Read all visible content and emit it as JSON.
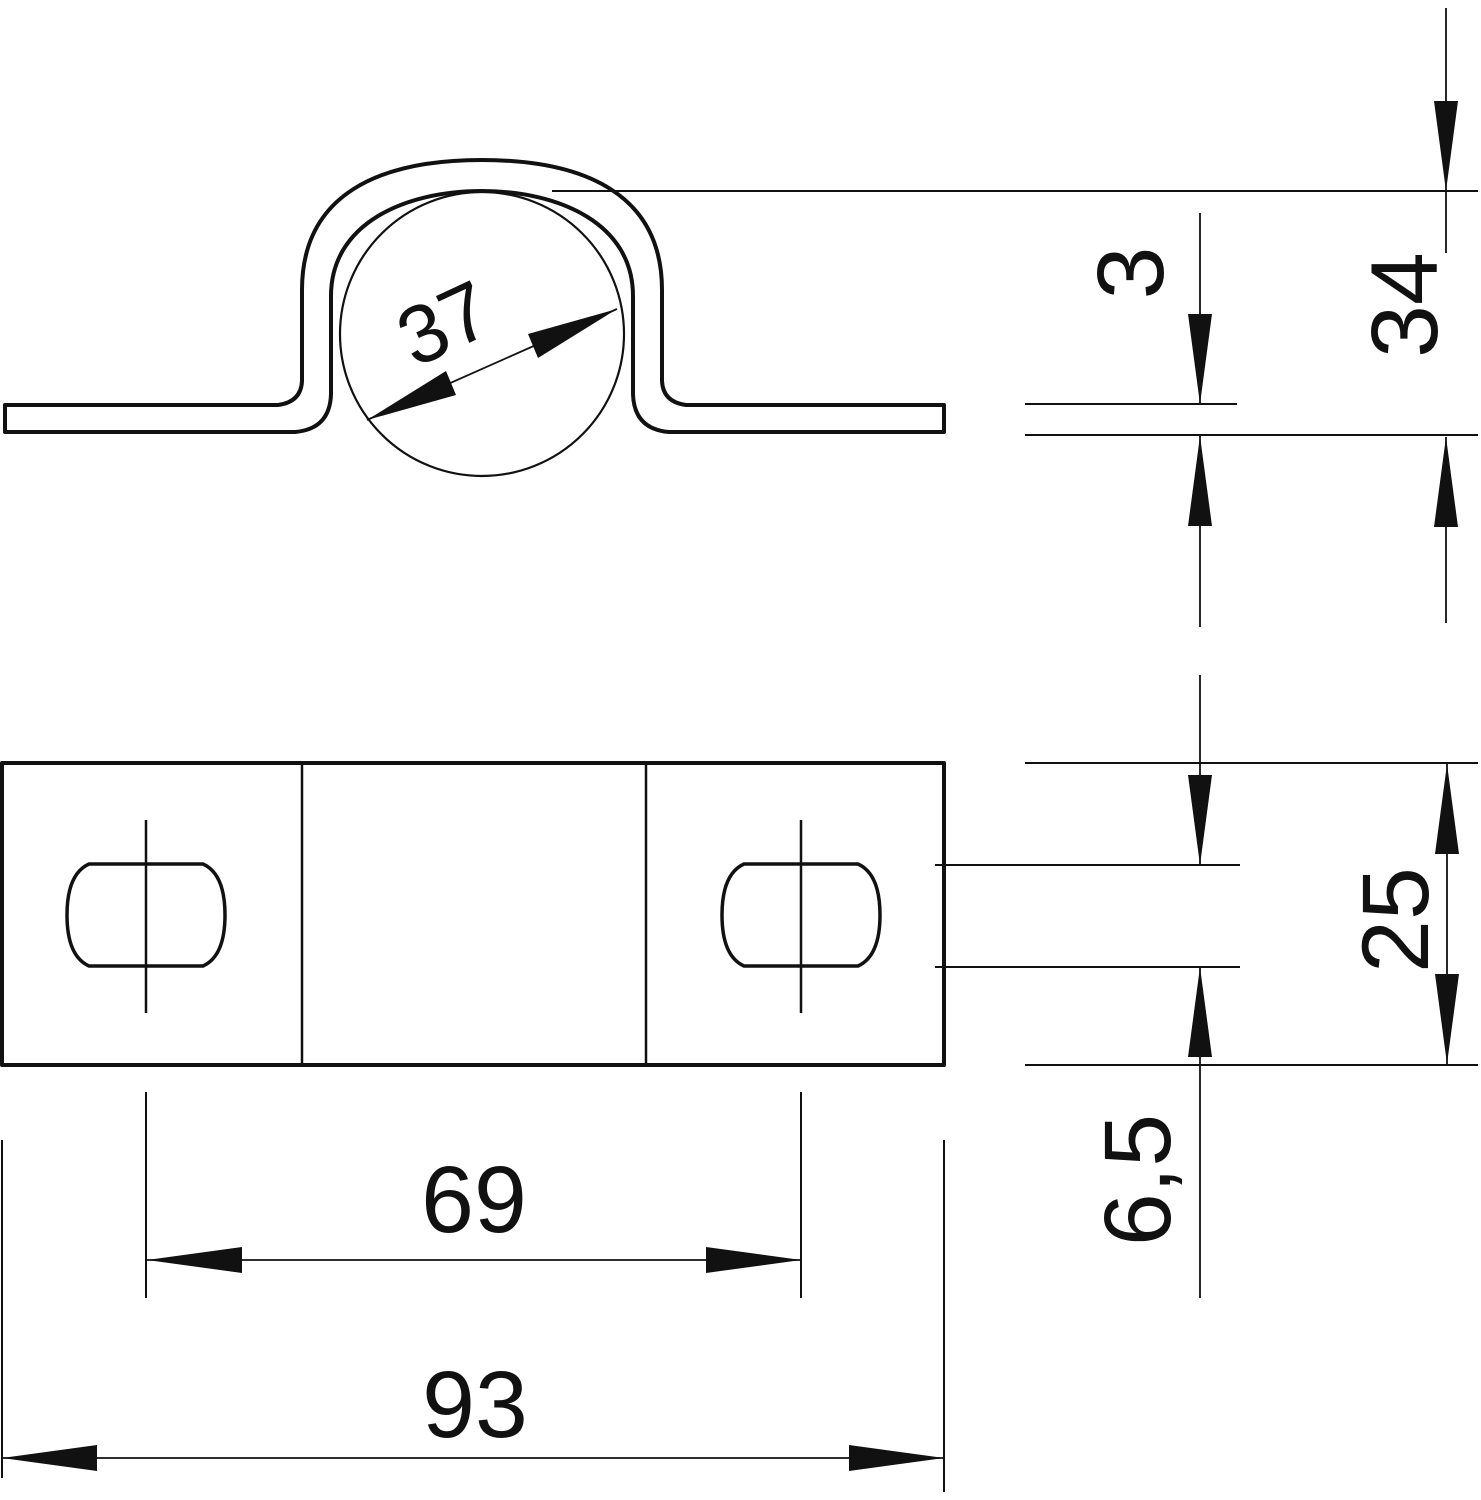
{
  "drawing": {
    "type": "technical dimension drawing",
    "subject": "saddle pipe clamp, side profile view and plan view with slotted fixing holes",
    "colors": {
      "line": "#111111",
      "background": "#ffffff"
    },
    "dimensions": {
      "pipe_diameter": {
        "label": "37"
      },
      "material_thickness": {
        "label": "3"
      },
      "overall_height": {
        "label": "34"
      },
      "strap_width": {
        "label": "25"
      },
      "slot_width": {
        "label": "6,5"
      },
      "hole_spacing": {
        "label": "69"
      },
      "overall_length": {
        "label": "93"
      }
    }
  }
}
